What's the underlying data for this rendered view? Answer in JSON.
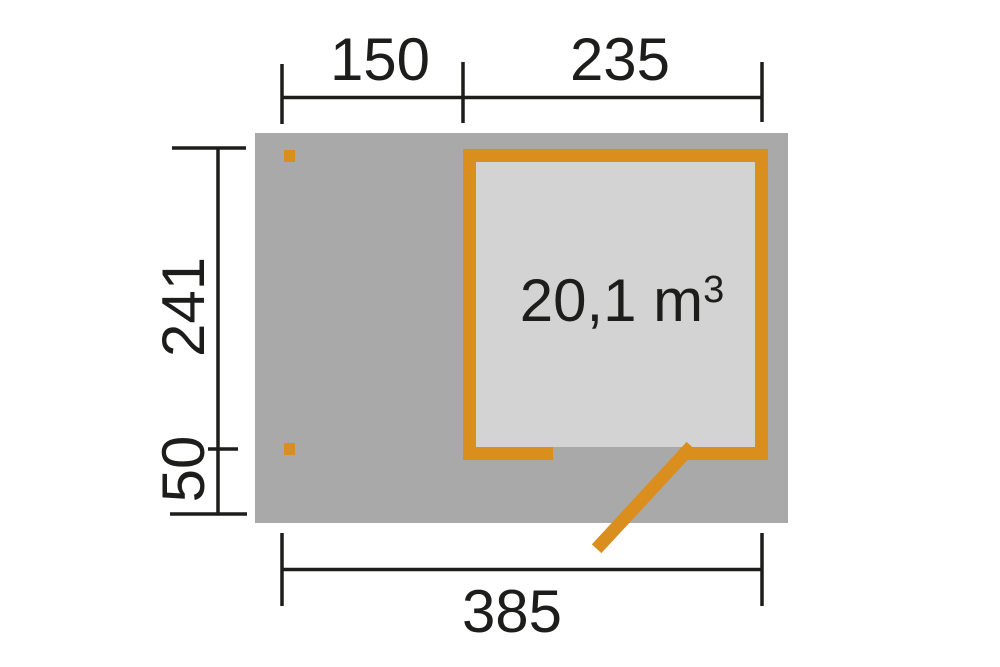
{
  "diagram": {
    "kind": "shed-floor-plan",
    "volume_label": {
      "text": "20,1 m",
      "superscript": "3"
    },
    "dimensions": {
      "top_segment_1": "150",
      "top_segment_2": "235",
      "side_upper": "241",
      "side_lower": "50",
      "bottom_total": "385"
    },
    "colors": {
      "accent": "#d98e1e",
      "footprint": "#a9a9a9",
      "interior": "#d3d3d3",
      "line": "#1d1d1b",
      "background": "#ffffff"
    }
  }
}
